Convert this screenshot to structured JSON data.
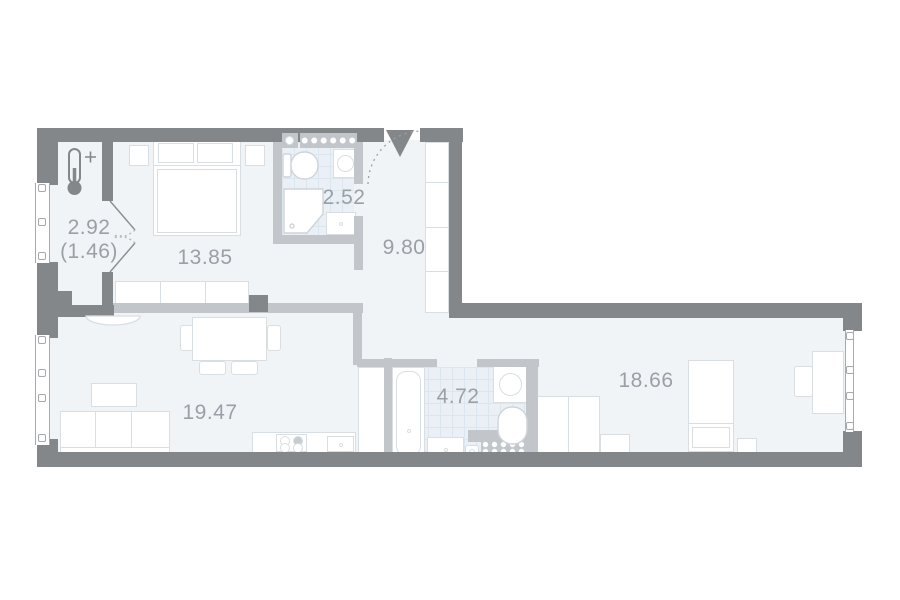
{
  "plan_title": "apartment-floor-plan",
  "theme": {
    "wall": "#84878a",
    "wall_light": "#c2c6ca",
    "floor": "#f0f4f7",
    "tile": "#eaf0f6",
    "tile_line": "#dce6ef",
    "furn": "#d9dee3",
    "label": "#9aa0a6",
    "outline": "#a6aaae"
  },
  "rooms": {
    "balcony": {
      "area": "2.92",
      "area_additional": "(1.46)"
    },
    "bedroom": {
      "area": "13.85"
    },
    "bathroom_top": {
      "area": "2.52"
    },
    "hallway": {
      "area": "9.80"
    },
    "living_kitchen": {
      "area": "19.47"
    },
    "bathroom_bottom": {
      "area": "4.72"
    },
    "bedroom_right": {
      "area": "18.66"
    }
  },
  "icons": [
    "thermometer-plus-icon",
    "entrance-triangle-icon",
    "door-swing-arc-icon",
    "vent-shaft-dots-icon"
  ]
}
